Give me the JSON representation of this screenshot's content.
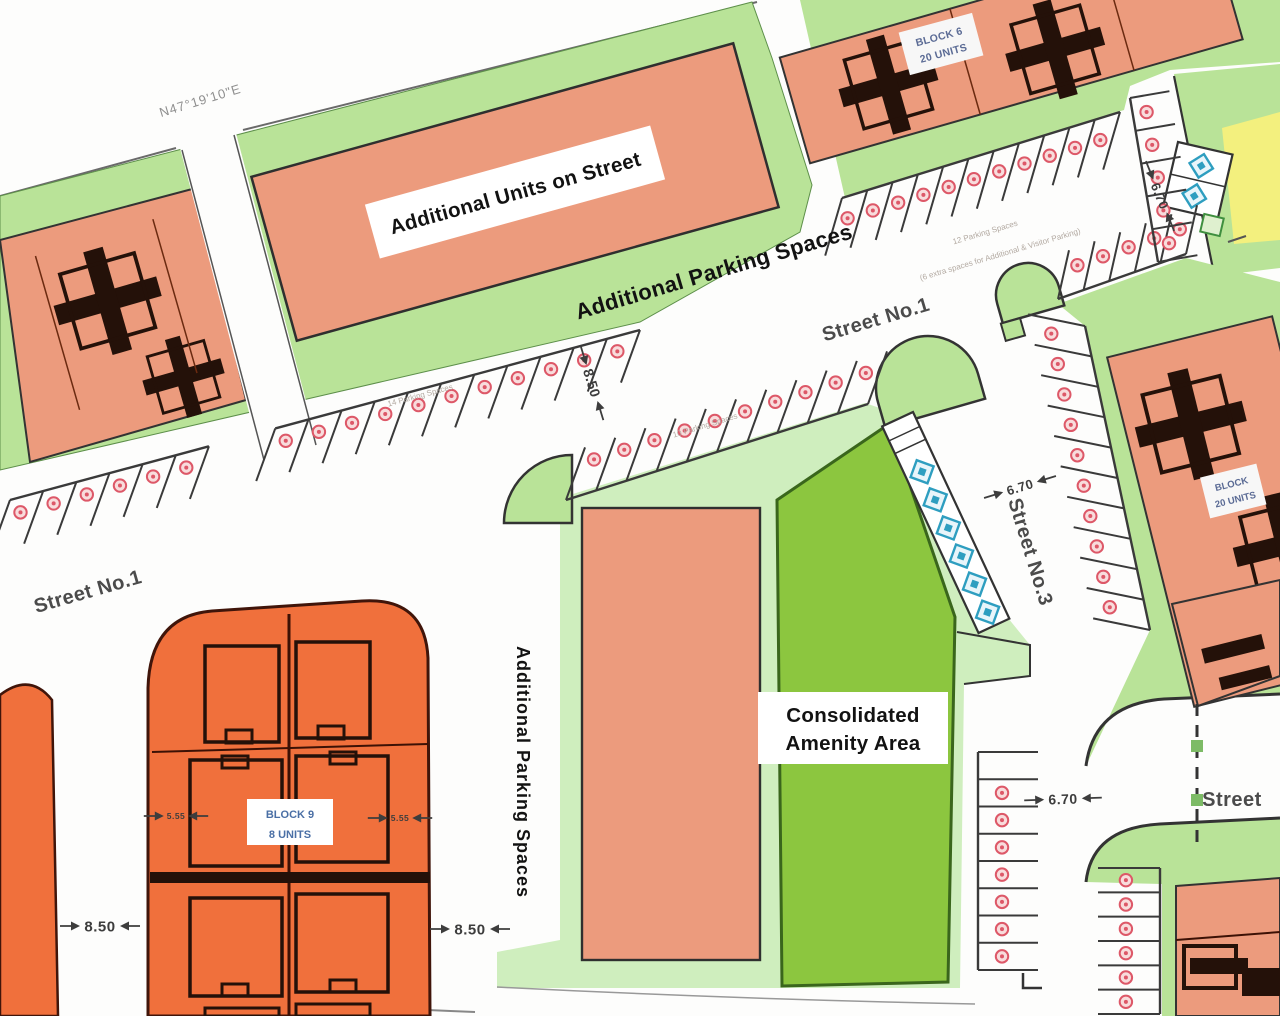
{
  "plan": {
    "boundary": {
      "bearing": "N47°19'10\"E",
      "length": "173.71"
    },
    "streets": {
      "street1_left": "Street No.1",
      "street1_center": "Street No.1",
      "street3": "Street No.3",
      "street_bottom": "Street"
    },
    "areas": {
      "additional_units": "Additional Units on Street",
      "additional_parking": "Additional Parking Spaces",
      "additional_parking_vertical": "Additional Parking Spaces",
      "amenity_line1": "Consolidated",
      "amenity_line2": "Amenity Area"
    },
    "blocks": {
      "block6_line1": "BLOCK 6",
      "block6_line2": "20 UNITS",
      "block_east_line1": "BLOCK",
      "block_east_line2": "20 UNITS",
      "block9_line1": "BLOCK 9",
      "block9_line2": "8 UNITS"
    },
    "annotations": {
      "row_left": "14 Parking Spaces",
      "row_center": "10 Parking Spaces",
      "row_right_a": "12 Parking Spaces",
      "row_right_b": "(6 extra spaces for Additional & Visitor Parking)"
    },
    "colors": {
      "salmon": "#EC9B7D",
      "orange": "#F0703C",
      "green_band": "#B9E398",
      "green_pale": "#CFEEBE",
      "green_bright": "#8CC63F",
      "yellow": "#F3F07E",
      "parking_dot": "#DD5868",
      "accessible_blue": "#2E9EC0",
      "footprint_dark": "#241109",
      "line_dark": "#333333"
    },
    "dim_marks": [
      {
        "text": "8.50",
        "x": 100,
        "y": 926,
        "rot": 0,
        "size": 15
      },
      {
        "text": "8.50",
        "x": 470,
        "y": 929,
        "rot": 0,
        "size": 15
      },
      {
        "text": "8.50",
        "x": 592,
        "y": 383,
        "rot": 73,
        "size": 14
      },
      {
        "text": "6.70",
        "x": 1063,
        "y": 799,
        "rot": -2,
        "size": 14
      },
      {
        "text": "6.70",
        "x": 1020,
        "y": 487,
        "rot": -17,
        "size": 13
      },
      {
        "text": "6.70",
        "x": 1160,
        "y": 196,
        "rot": 68,
        "size": 13
      },
      {
        "text": "5.55",
        "x": 176,
        "y": 816,
        "rot": 0,
        "size": 8.5
      },
      {
        "text": "5.55",
        "x": 400,
        "y": 818,
        "rot": 0,
        "size": 8.5
      }
    ],
    "parking_rows": [
      {
        "id": "street1-upper-left",
        "x1": 10,
        "y1": 500,
        "x2": 640,
        "y2": 330,
        "n": 19,
        "depth": 56,
        "dx": -0.34,
        "dy": 0.94,
        "circle_t": 0.32,
        "skip": [
          6,
          7
        ]
      },
      {
        "id": "street1-lower-center",
        "x1": 566,
        "y1": 500,
        "x2": 868,
        "y2": 404,
        "n": 10,
        "depth": 56,
        "dx": 0.34,
        "dy": -0.94,
        "circle_t": 0.68
      },
      {
        "id": "street1-upper-right",
        "x1": 842,
        "y1": 198,
        "x2": 1120,
        "y2": 112,
        "n": 11,
        "depth": 60,
        "dx": -0.28,
        "dy": 0.96,
        "circle_t": 0.42
      },
      {
        "id": "junction-south",
        "x1": 1058,
        "y1": 299,
        "x2": 1186,
        "y2": 254,
        "n": 5,
        "depth": 50,
        "dx": 0.22,
        "dy": -0.975,
        "circle_t": 0.6
      },
      {
        "id": "street3-east",
        "x1": 1085,
        "y1": 326,
        "x2": 1150,
        "y2": 630,
        "n": 10,
        "depth": 58,
        "dx": -0.98,
        "dy": -0.2,
        "circle_t": 0.65
      },
      {
        "id": "south-column-west",
        "x1": 978,
        "y1": 752,
        "x2": 978,
        "y2": 970,
        "n": 8,
        "depth": 60,
        "dx": 1,
        "dy": 0,
        "circle_t": 0.4,
        "skip_circles": [
          0
        ]
      },
      {
        "id": "south-column-east",
        "x1": 1160,
        "y1": 868,
        "x2": 1160,
        "y2": 1014,
        "n": 6,
        "depth": 62,
        "dx": -1,
        "dy": 0,
        "circle_t": 0.55
      },
      {
        "id": "northeast-corridor",
        "x1": 1130,
        "y1": 98,
        "x2": 1158,
        "y2": 262,
        "n": 5,
        "depth": 40,
        "dx": 0.985,
        "dy": -0.17,
        "circle_t": 0.35
      }
    ],
    "accessible": {
      "strip_count": 6,
      "box_count": 2
    }
  }
}
